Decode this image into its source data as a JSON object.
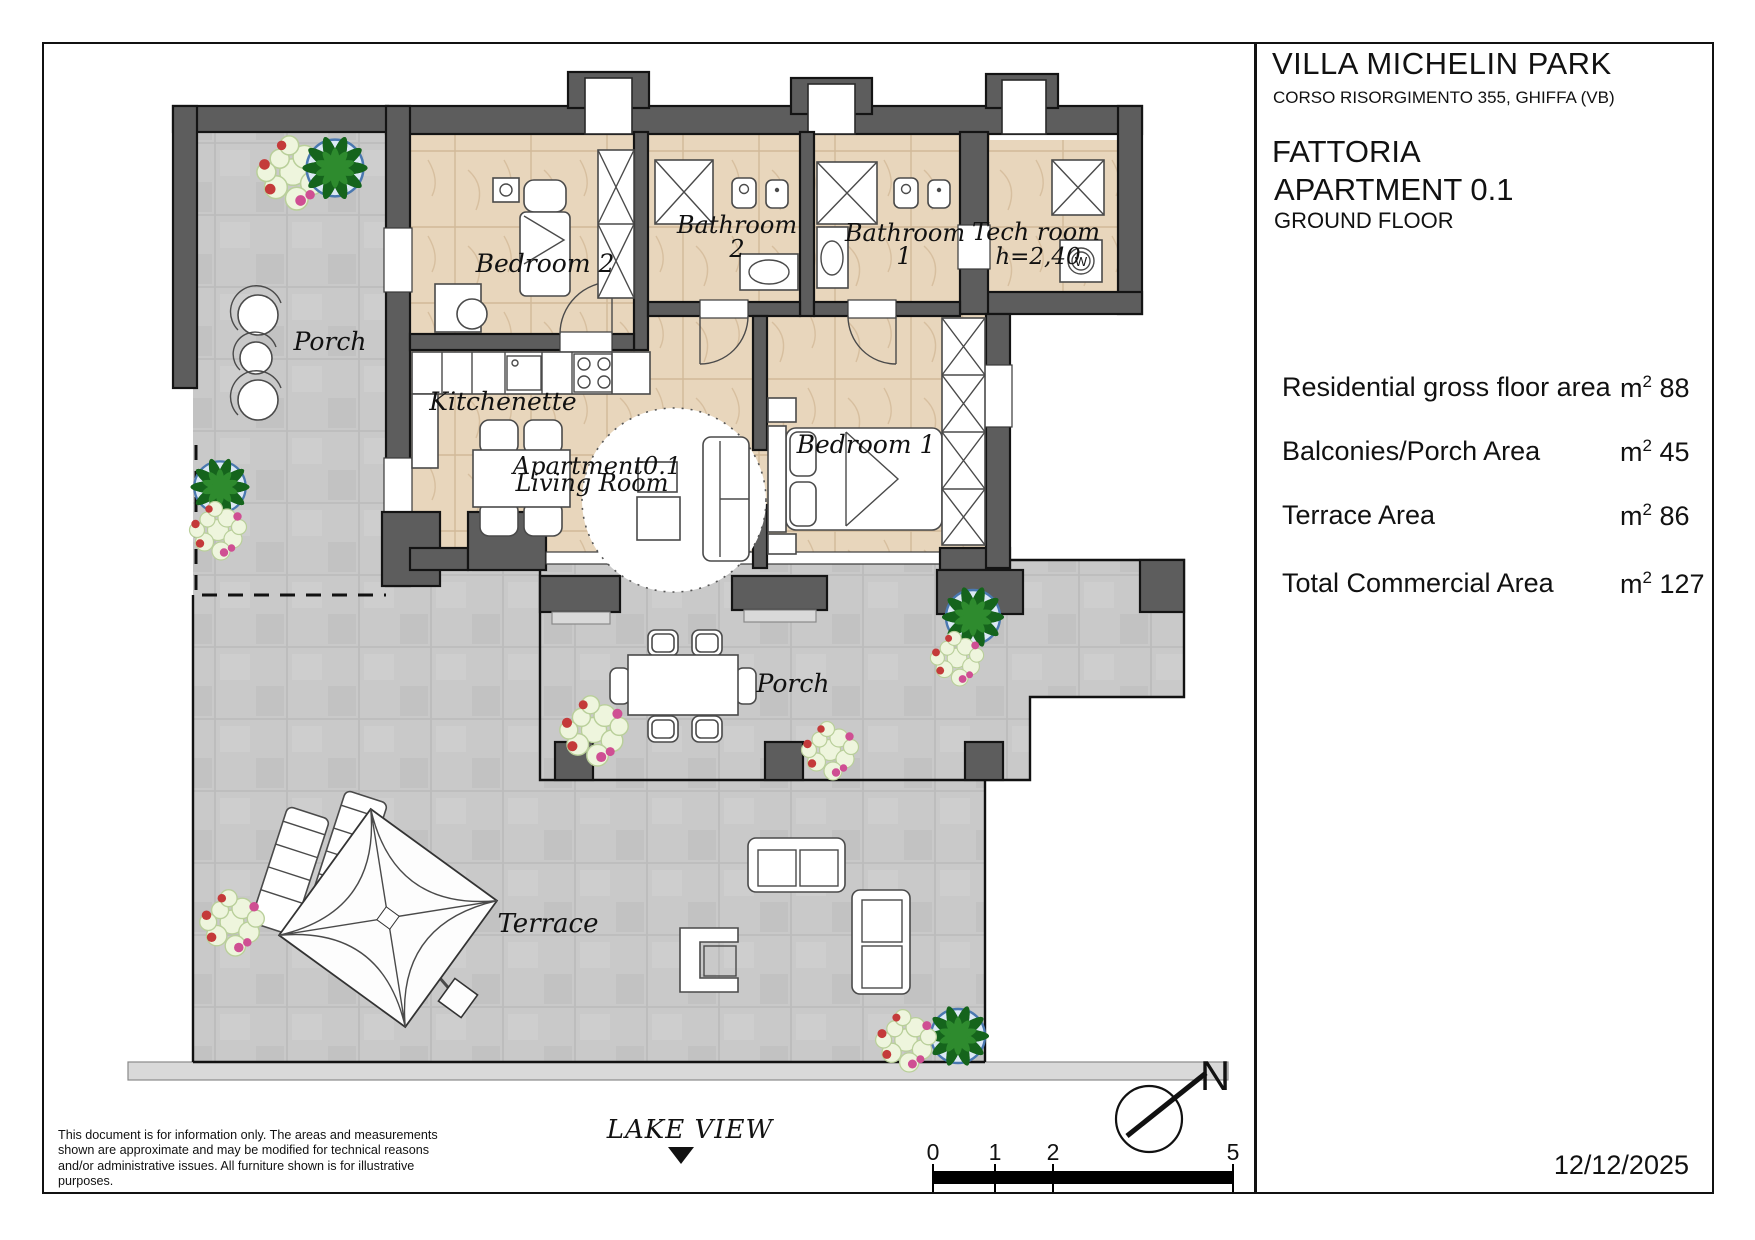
{
  "title_block": {
    "project": "VILLA MICHELIN PARK",
    "address": "CORSO RISORGIMENTO 355, GHIFFA (VB)",
    "building": "FATTORIA",
    "unit": "APARTMENT 0.1",
    "floor": "GROUND FLOOR",
    "date": "12/12/2025"
  },
  "areas": {
    "unit_base": "m",
    "unit_sup": "2",
    "rows": [
      {
        "label": "Residential gross floor area",
        "value": "88"
      },
      {
        "label": "Balconies/Porch Area",
        "value": "45"
      },
      {
        "label": "Terrace Area",
        "value": "86"
      },
      {
        "label": "Total Commercial Area",
        "value": "127"
      }
    ]
  },
  "plan": {
    "rooms": {
      "bedroom2": "Bedroom 2",
      "bathroom2_l1": "Bathroom",
      "bathroom2_l2": "2",
      "bathroom1_l1": "Bathroom",
      "bathroom1_l2": "1",
      "tech_room": "Tech room",
      "tech_height": "h=2,40",
      "washer": "W",
      "porch_left": "Porch",
      "kitchenette": "Kitchenette",
      "apartment_code": "Apartment0.1",
      "living_room": "Living Room",
      "bedroom1": "Bedroom 1",
      "porch_main": "Porch",
      "terrace": "Terrace"
    },
    "annotations": {
      "lake_view": "LAKE VIEW",
      "north": "N"
    },
    "scale_labels": [
      "0",
      "1",
      "2",
      "5"
    ]
  },
  "disclaimer": "This document is for information only. The areas and measurements shown are approximate and may be modified for technical reasons and/or administrative issues. All furniture shown is for illustrative purposes.",
  "colors": {
    "wall": "#5d5d5d",
    "interior_floor": "#e8d6bc",
    "outdoor_tile": "#c9c9c9",
    "line": "#141414",
    "plant_green": "#15641c",
    "pot_blue": "#4a78b0"
  }
}
